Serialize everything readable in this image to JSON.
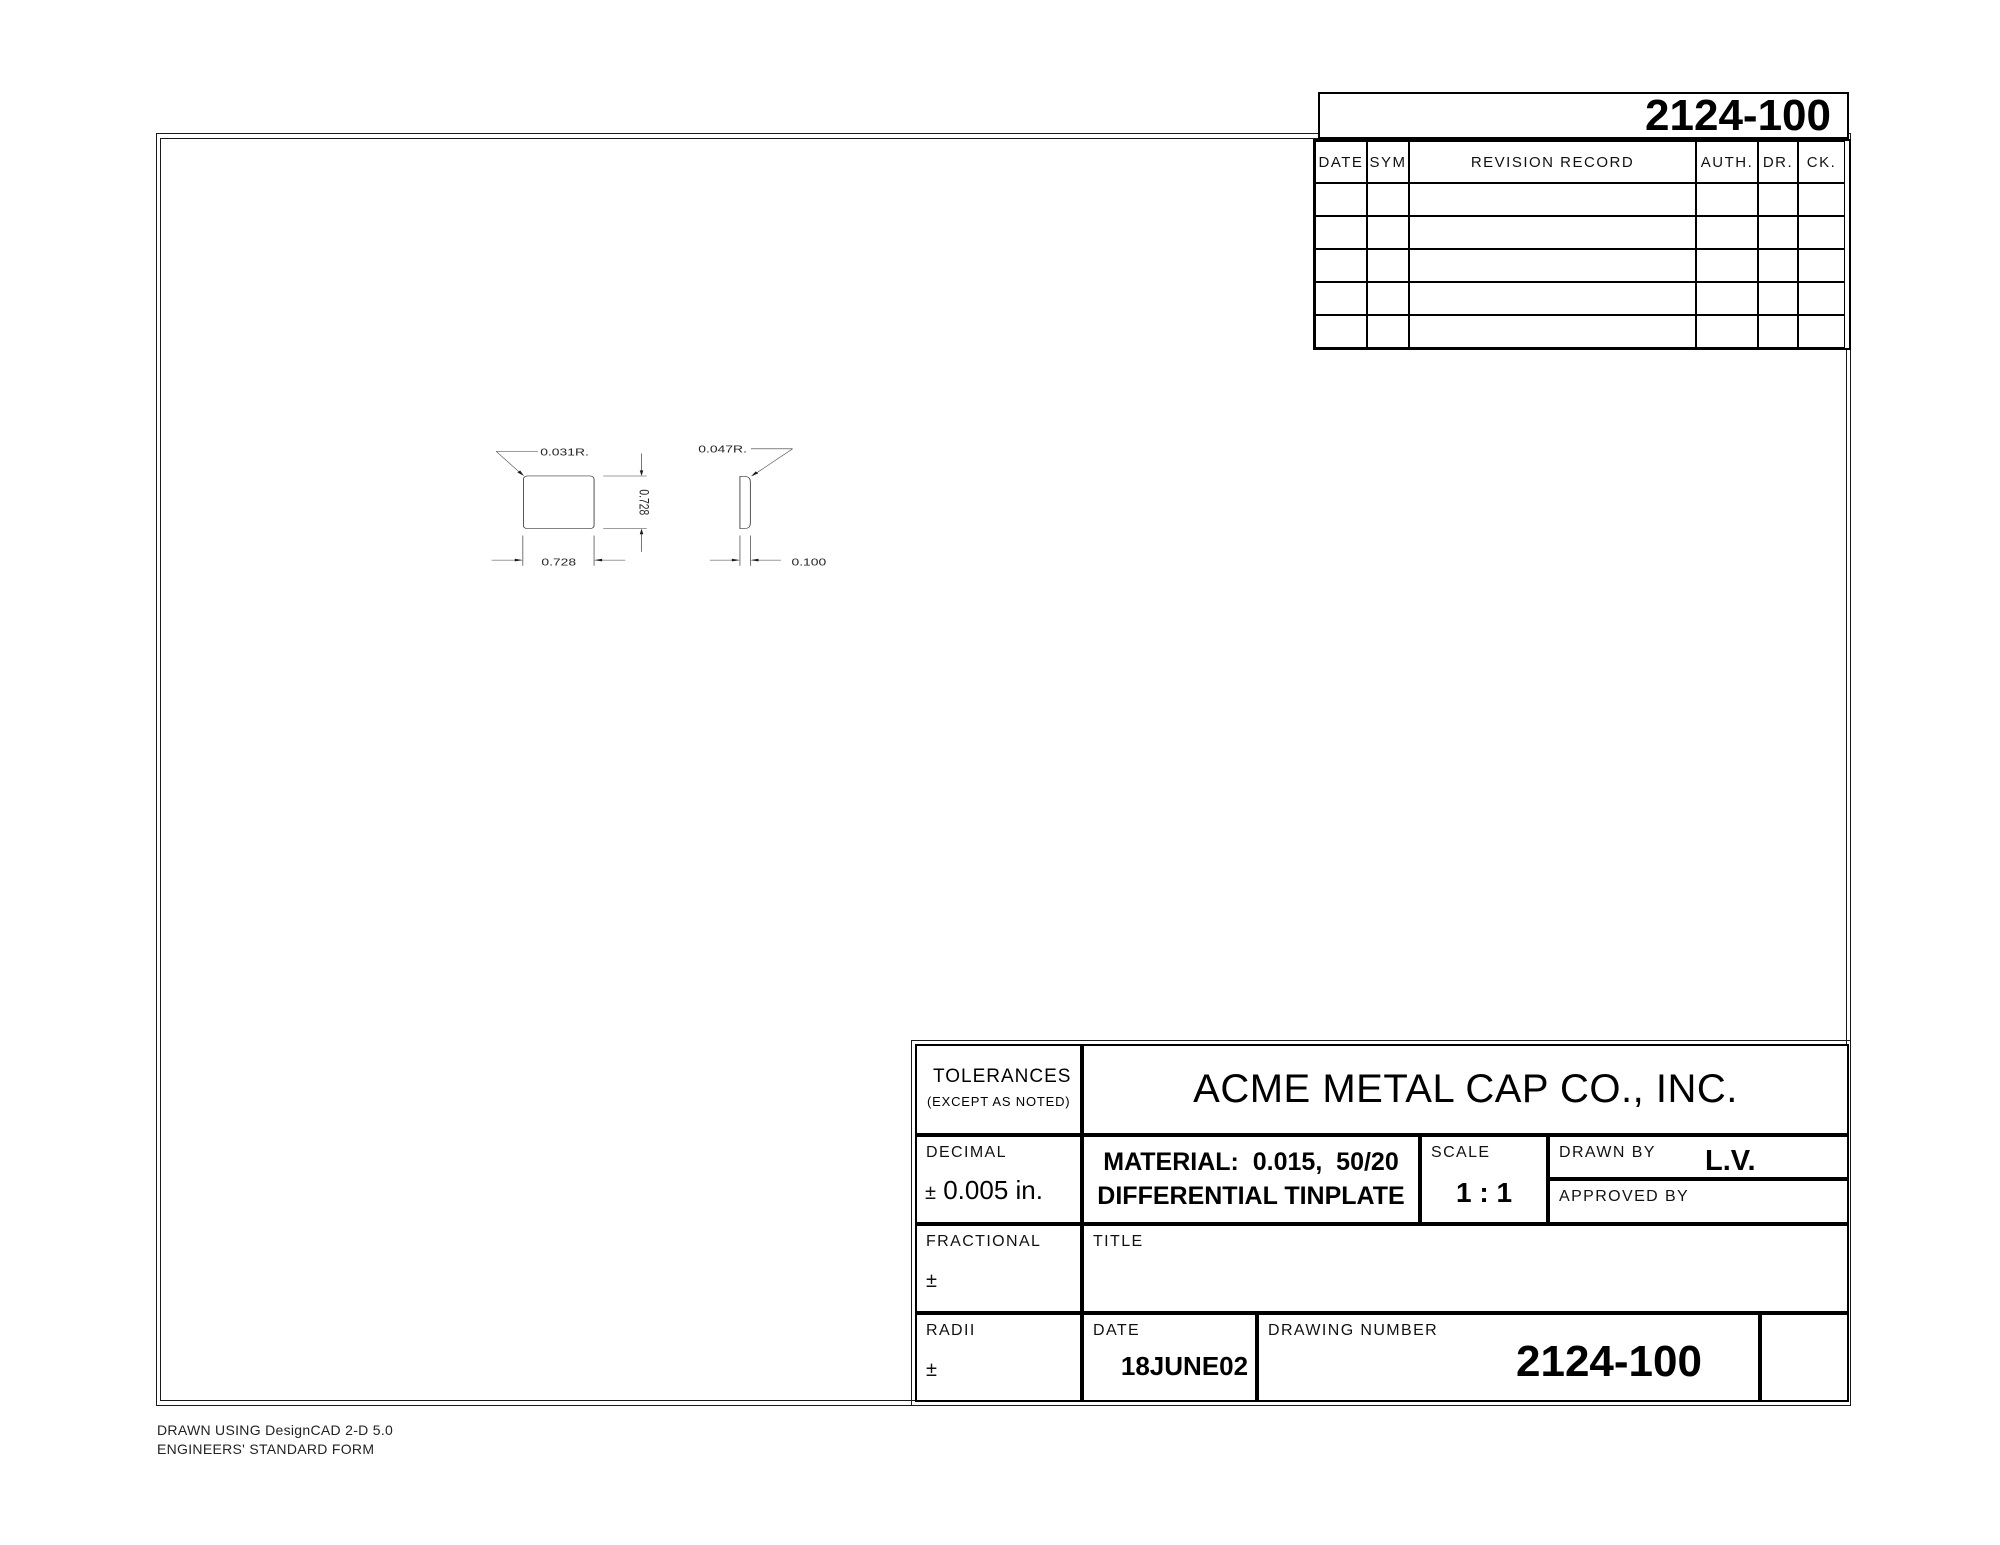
{
  "revision_block": {
    "sheet_number": "2124-100",
    "headers": [
      "DATE",
      "SYM",
      "REVISION RECORD",
      "AUTH.",
      "DR.",
      "CK."
    ]
  },
  "views": {
    "front": {
      "radius_label": "0.031R.",
      "height_dim": "0.728",
      "width_dim": "0.728"
    },
    "side": {
      "radius_label": "0.047R.",
      "thickness_dim": "0.100"
    }
  },
  "title_block": {
    "tolerances_label": "TOLERANCES",
    "tolerances_note": "(EXCEPT AS NOTED)",
    "company_name": "ACME METAL CAP CO., INC.",
    "decimal_label": "DECIMAL",
    "plus_minus": "±",
    "decimal_value": "0.005 in.",
    "material_line1": "MATERIAL:  0.015,  50/20",
    "material_line2": "DIFFERENTIAL TINPLATE",
    "scale_label": "SCALE",
    "scale_value": "1 : 1",
    "drawn_by_label": "DRAWN BY",
    "drawn_by_value": "L.V.",
    "approved_by_label": "APPROVED BY",
    "fractional_label": "FRACTIONAL",
    "title_label": "TITLE",
    "radii_label": "RADII",
    "date_label": "DATE",
    "date_value": "18JUNE02",
    "drawing_number_label": "DRAWING NUMBER",
    "drawing_number_value": "2124-100"
  },
  "footer": {
    "line1": "DRAWN USING DesignCAD 2-D 5.0",
    "line2": "ENGINEERS' STANDARD FORM"
  }
}
